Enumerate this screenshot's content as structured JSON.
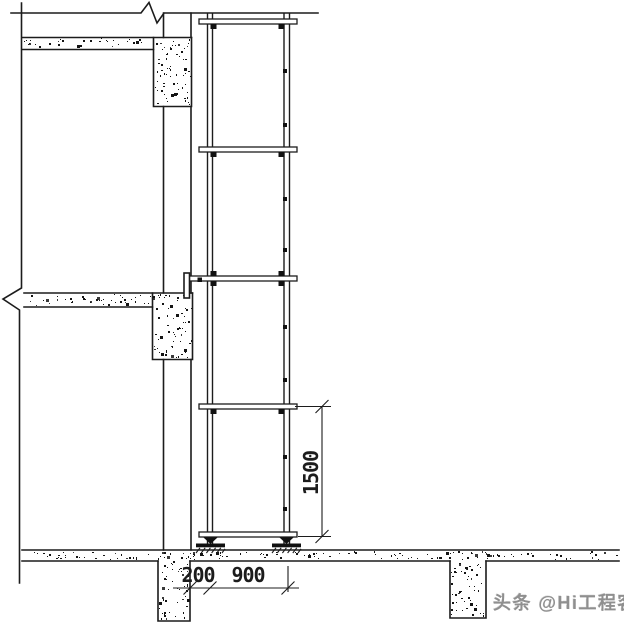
{
  "dimensions": {
    "bay_height": "1500",
    "wall_clearance": "200",
    "row_spacing": "900"
  },
  "watermark": {
    "text": "头条 @Hi工程客"
  },
  "colors": {
    "line": "#1c1c1c",
    "watermark_gray": "#8f8f8f",
    "paper": "#ffffff"
  }
}
